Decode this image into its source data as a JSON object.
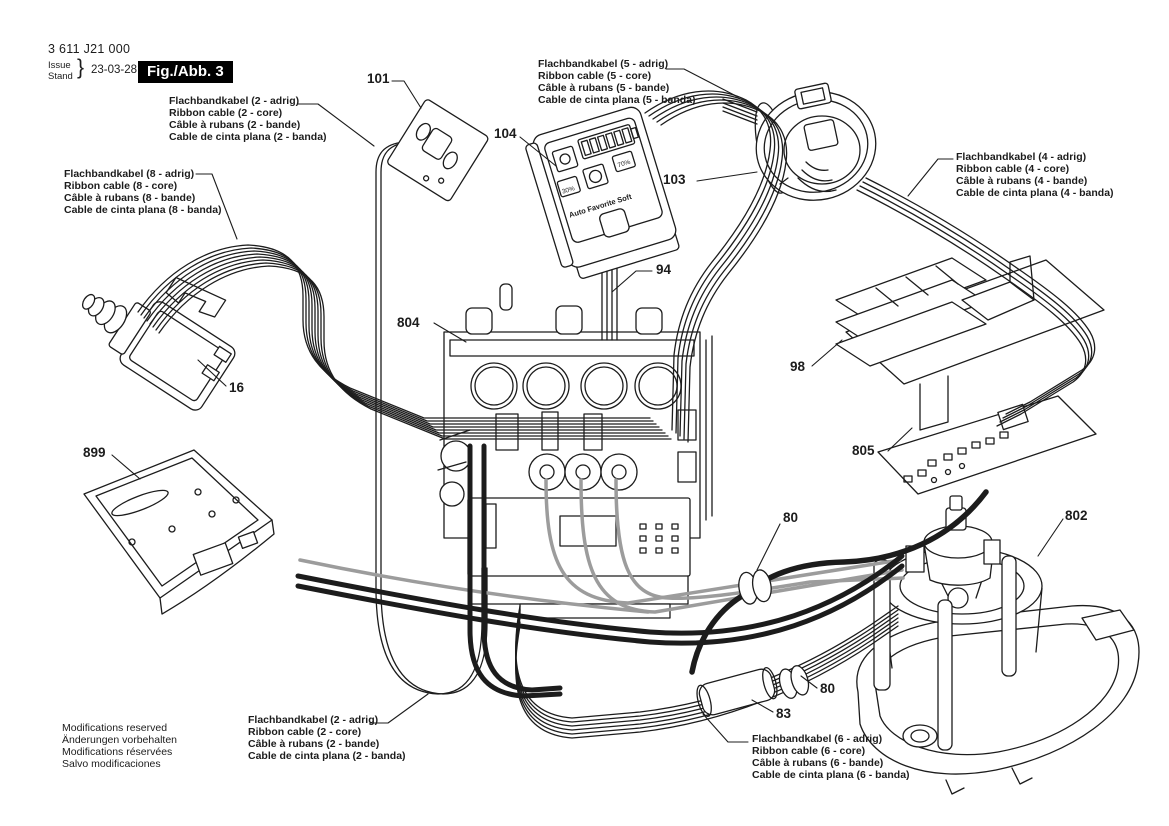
{
  "header": {
    "part_number": "3 611 J21 000",
    "issue_en": "Issue",
    "issue_de": "Stand",
    "brace": "}",
    "date": "23-03-28",
    "figure": "Fig./Abb. 3"
  },
  "footer": {
    "lines": [
      "Modifications reserved",
      "Änderungen vorbehalten",
      "Modifications réservées",
      "Salvo modificaciones"
    ]
  },
  "cable_labels": [
    {
      "id": "ribbon-2core-top",
      "lines": [
        "Flachbandkabel (2 - adrig)",
        "Ribbon cable (2 - core)",
        "Câble à rubans (2 - bande)",
        "Cable de cinta plana (2 - banda)"
      ]
    },
    {
      "id": "ribbon-5core",
      "lines": [
        "Flachbandkabel (5 - adrig)",
        "Ribbon cable (5 - core)",
        "Câble à rubans (5 - bande)",
        "Cable de cinta plana (5 - banda)"
      ]
    },
    {
      "id": "ribbon-4core",
      "lines": [
        "Flachbandkabel (4 - adrig)",
        "Ribbon cable (4 - core)",
        "Câble à rubans (4 - bande)",
        "Cable de cinta plana (4 - banda)"
      ]
    },
    {
      "id": "ribbon-8core",
      "lines": [
        "Flachbandkabel (8 - adrig)",
        "Ribbon cable (8 - core)",
        "Câble à rubans (8 - bande)",
        "Cable de cinta plana (8 - banda)"
      ]
    },
    {
      "id": "ribbon-2core-bottom",
      "lines": [
        "Flachbandkabel (2 - adrig)",
        "Ribbon cable (2 - core)",
        "Câble à rubans (2 - bande)",
        "Cable de cinta plana (2 - banda)"
      ]
    },
    {
      "id": "ribbon-6core",
      "lines": [
        "Flachbandkabel (6 - adrig)",
        "Ribbon cable (6 - core)",
        "Câble à rubans (6 - bande)",
        "Cable de cinta plana (6 - banda)"
      ]
    }
  ],
  "parts": {
    "p101": "101",
    "p104": "104",
    "p103": "103",
    "p94": "94",
    "p804": "804",
    "p16": "16",
    "p899": "899",
    "p98": "98",
    "p805": "805",
    "p80a": "80",
    "p802": "802",
    "p80b": "80",
    "p83": "83"
  },
  "display_unit": {
    "mode_labels": "Auto Favorite Soft",
    "percent_left": "30%",
    "percent_right": "70%",
    "battery_segments": 6
  },
  "colors": {
    "line": "#1c1c1c",
    "cable_gray": "#9c9c9c",
    "background": "#ffffff",
    "figure_box_bg": "#000000",
    "figure_box_text": "#ffffff"
  }
}
